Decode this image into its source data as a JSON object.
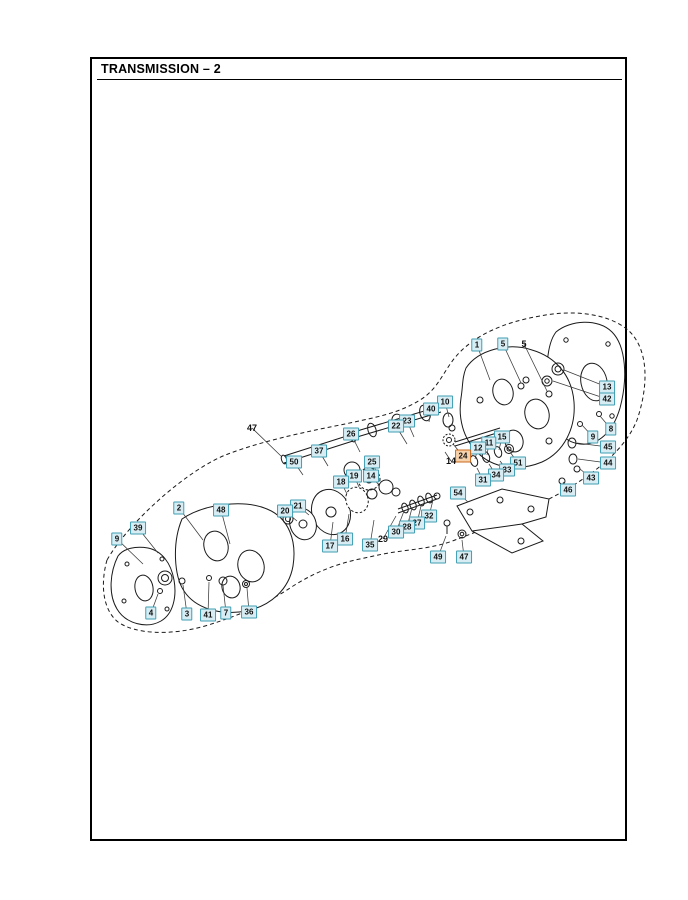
{
  "page": {
    "title": "TRANSMISSION – 2"
  },
  "colors": {
    "callout_fill": "#d8edf3",
    "callout_border": "#3f9eb3",
    "selected_fill": "#f6d2ac",
    "selected_border": "#c96a1e",
    "line": "#1a1a1a",
    "page_border": "#000000"
  },
  "callouts": [
    {
      "n": "1",
      "x": 477,
      "y": 345,
      "tx": 490,
      "ty": 380,
      "style": "box"
    },
    {
      "n": "5",
      "x": 503,
      "y": 344,
      "tx": 521,
      "ty": 383,
      "style": "box"
    },
    {
      "n": "5",
      "x": 524,
      "y": 344,
      "tx": 547,
      "ty": 391,
      "style": "plain"
    },
    {
      "n": "10",
      "x": 445,
      "y": 402,
      "tx": 449,
      "ty": 417,
      "style": "box"
    },
    {
      "n": "40",
      "x": 431,
      "y": 409,
      "tx": 429,
      "ty": 422,
      "style": "box"
    },
    {
      "n": "23",
      "x": 407,
      "y": 421,
      "tx": 414,
      "ty": 437,
      "style": "box"
    },
    {
      "n": "22",
      "x": 396,
      "y": 426,
      "tx": 407,
      "ty": 444,
      "style": "box"
    },
    {
      "n": "13",
      "x": 607,
      "y": 387,
      "tx": 564,
      "ty": 370,
      "style": "box"
    },
    {
      "n": "42",
      "x": 607,
      "y": 399,
      "tx": 553,
      "ty": 381,
      "style": "box"
    },
    {
      "n": "8",
      "x": 611,
      "y": 429,
      "tx": 600,
      "ty": 416,
      "style": "box"
    },
    {
      "n": "9",
      "x": 593,
      "y": 437,
      "tx": 582,
      "ty": 425,
      "style": "box"
    },
    {
      "n": "45",
      "x": 608,
      "y": 447,
      "tx": 577,
      "ty": 443,
      "style": "box"
    },
    {
      "n": "44",
      "x": 608,
      "y": 463,
      "tx": 578,
      "ty": 459,
      "style": "box"
    },
    {
      "n": "43",
      "x": 591,
      "y": 478,
      "tx": 580,
      "ty": 469,
      "style": "box"
    },
    {
      "n": "46",
      "x": 568,
      "y": 490,
      "tx": 563,
      "ty": 482,
      "style": "box"
    },
    {
      "n": "15",
      "x": 502,
      "y": 437,
      "tx": 499,
      "ty": 450,
      "style": "box"
    },
    {
      "n": "11",
      "x": 489,
      "y": 443,
      "tx": 487,
      "ty": 455,
      "style": "box"
    },
    {
      "n": "12",
      "x": 478,
      "y": 448,
      "tx": 475,
      "ty": 459,
      "style": "box"
    },
    {
      "n": "24",
      "x": 463,
      "y": 456,
      "tx": 453,
      "ty": 444,
      "style": "selected"
    },
    {
      "n": "14",
      "x": 451,
      "y": 461,
      "tx": 445,
      "ty": 452,
      "style": "plain"
    },
    {
      "n": "51",
      "x": 518,
      "y": 463,
      "tx": 510,
      "ty": 452,
      "style": "box"
    },
    {
      "n": "33",
      "x": 507,
      "y": 470,
      "tx": 500,
      "ty": 461,
      "style": "box"
    },
    {
      "n": "34",
      "x": 496,
      "y": 475,
      "tx": 489,
      "ty": 464,
      "style": "box"
    },
    {
      "n": "31",
      "x": 483,
      "y": 480,
      "tx": 477,
      "ty": 468,
      "style": "box"
    },
    {
      "n": "54",
      "x": 458,
      "y": 493,
      "tx": 468,
      "ty": 502,
      "style": "box"
    },
    {
      "n": "32",
      "x": 429,
      "y": 516,
      "tx": 433,
      "ty": 500,
      "style": "box"
    },
    {
      "n": "27",
      "x": 417,
      "y": 523,
      "tx": 421,
      "ty": 506,
      "style": "box"
    },
    {
      "n": "28",
      "x": 407,
      "y": 527,
      "tx": 412,
      "ty": 508,
      "style": "box"
    },
    {
      "n": "30",
      "x": 396,
      "y": 532,
      "tx": 404,
      "ty": 511,
      "style": "box"
    },
    {
      "n": "29",
      "x": 383,
      "y": 539,
      "tx": 396,
      "ty": 516,
      "style": "plain"
    },
    {
      "n": "49",
      "x": 438,
      "y": 557,
      "tx": 446,
      "ty": 536,
      "style": "box"
    },
    {
      "n": "47",
      "x": 464,
      "y": 557,
      "tx": 462,
      "ty": 540,
      "style": "box"
    },
    {
      "n": "35",
      "x": 370,
      "y": 545,
      "tx": 374,
      "ty": 520,
      "style": "box"
    },
    {
      "n": "16",
      "x": 345,
      "y": 539,
      "tx": 349,
      "ty": 514,
      "style": "box"
    },
    {
      "n": "17",
      "x": 330,
      "y": 546,
      "tx": 333,
      "ty": 522,
      "style": "box"
    },
    {
      "n": "26",
      "x": 351,
      "y": 434,
      "tx": 360,
      "ty": 452,
      "style": "box"
    },
    {
      "n": "37",
      "x": 319,
      "y": 451,
      "tx": 328,
      "ty": 466,
      "style": "box"
    },
    {
      "n": "50",
      "x": 294,
      "y": 462,
      "tx": 303,
      "ty": 475,
      "style": "box"
    },
    {
      "n": "25",
      "x": 372,
      "y": 462,
      "tx": 376,
      "ty": 471,
      "style": "box"
    },
    {
      "n": "14",
      "x": 371,
      "y": 476,
      "tx": 378,
      "ty": 484,
      "style": "box"
    },
    {
      "n": "19",
      "x": 354,
      "y": 476,
      "tx": 359,
      "ty": 487,
      "style": "box"
    },
    {
      "n": "18",
      "x": 341,
      "y": 482,
      "tx": 347,
      "ty": 494,
      "style": "box"
    },
    {
      "n": "21",
      "x": 298,
      "y": 506,
      "tx": 309,
      "ty": 515,
      "style": "box"
    },
    {
      "n": "20",
      "x": 285,
      "y": 511,
      "tx": 297,
      "ty": 521,
      "style": "box"
    },
    {
      "n": "47",
      "x": 252,
      "y": 428,
      "tx": 281,
      "ty": 456,
      "style": "plain"
    },
    {
      "n": "2",
      "x": 179,
      "y": 508,
      "tx": 203,
      "ty": 540,
      "style": "box"
    },
    {
      "n": "48",
      "x": 221,
      "y": 510,
      "tx": 230,
      "ty": 544,
      "style": "box"
    },
    {
      "n": "39",
      "x": 138,
      "y": 528,
      "tx": 158,
      "ty": 553,
      "style": "box"
    },
    {
      "n": "9",
      "x": 117,
      "y": 539,
      "tx": 143,
      "ty": 564,
      "style": "box"
    },
    {
      "n": "4",
      "x": 151,
      "y": 613,
      "tx": 158,
      "ty": 594,
      "style": "box"
    },
    {
      "n": "3",
      "x": 187,
      "y": 614,
      "tx": 183,
      "ty": 585,
      "style": "box"
    },
    {
      "n": "41",
      "x": 208,
      "y": 615,
      "tx": 209,
      "ty": 582,
      "style": "box"
    },
    {
      "n": "7",
      "x": 226,
      "y": 613,
      "tx": 223,
      "ty": 585,
      "style": "box"
    },
    {
      "n": "36",
      "x": 249,
      "y": 612,
      "tx": 247,
      "ty": 588,
      "style": "box"
    }
  ]
}
